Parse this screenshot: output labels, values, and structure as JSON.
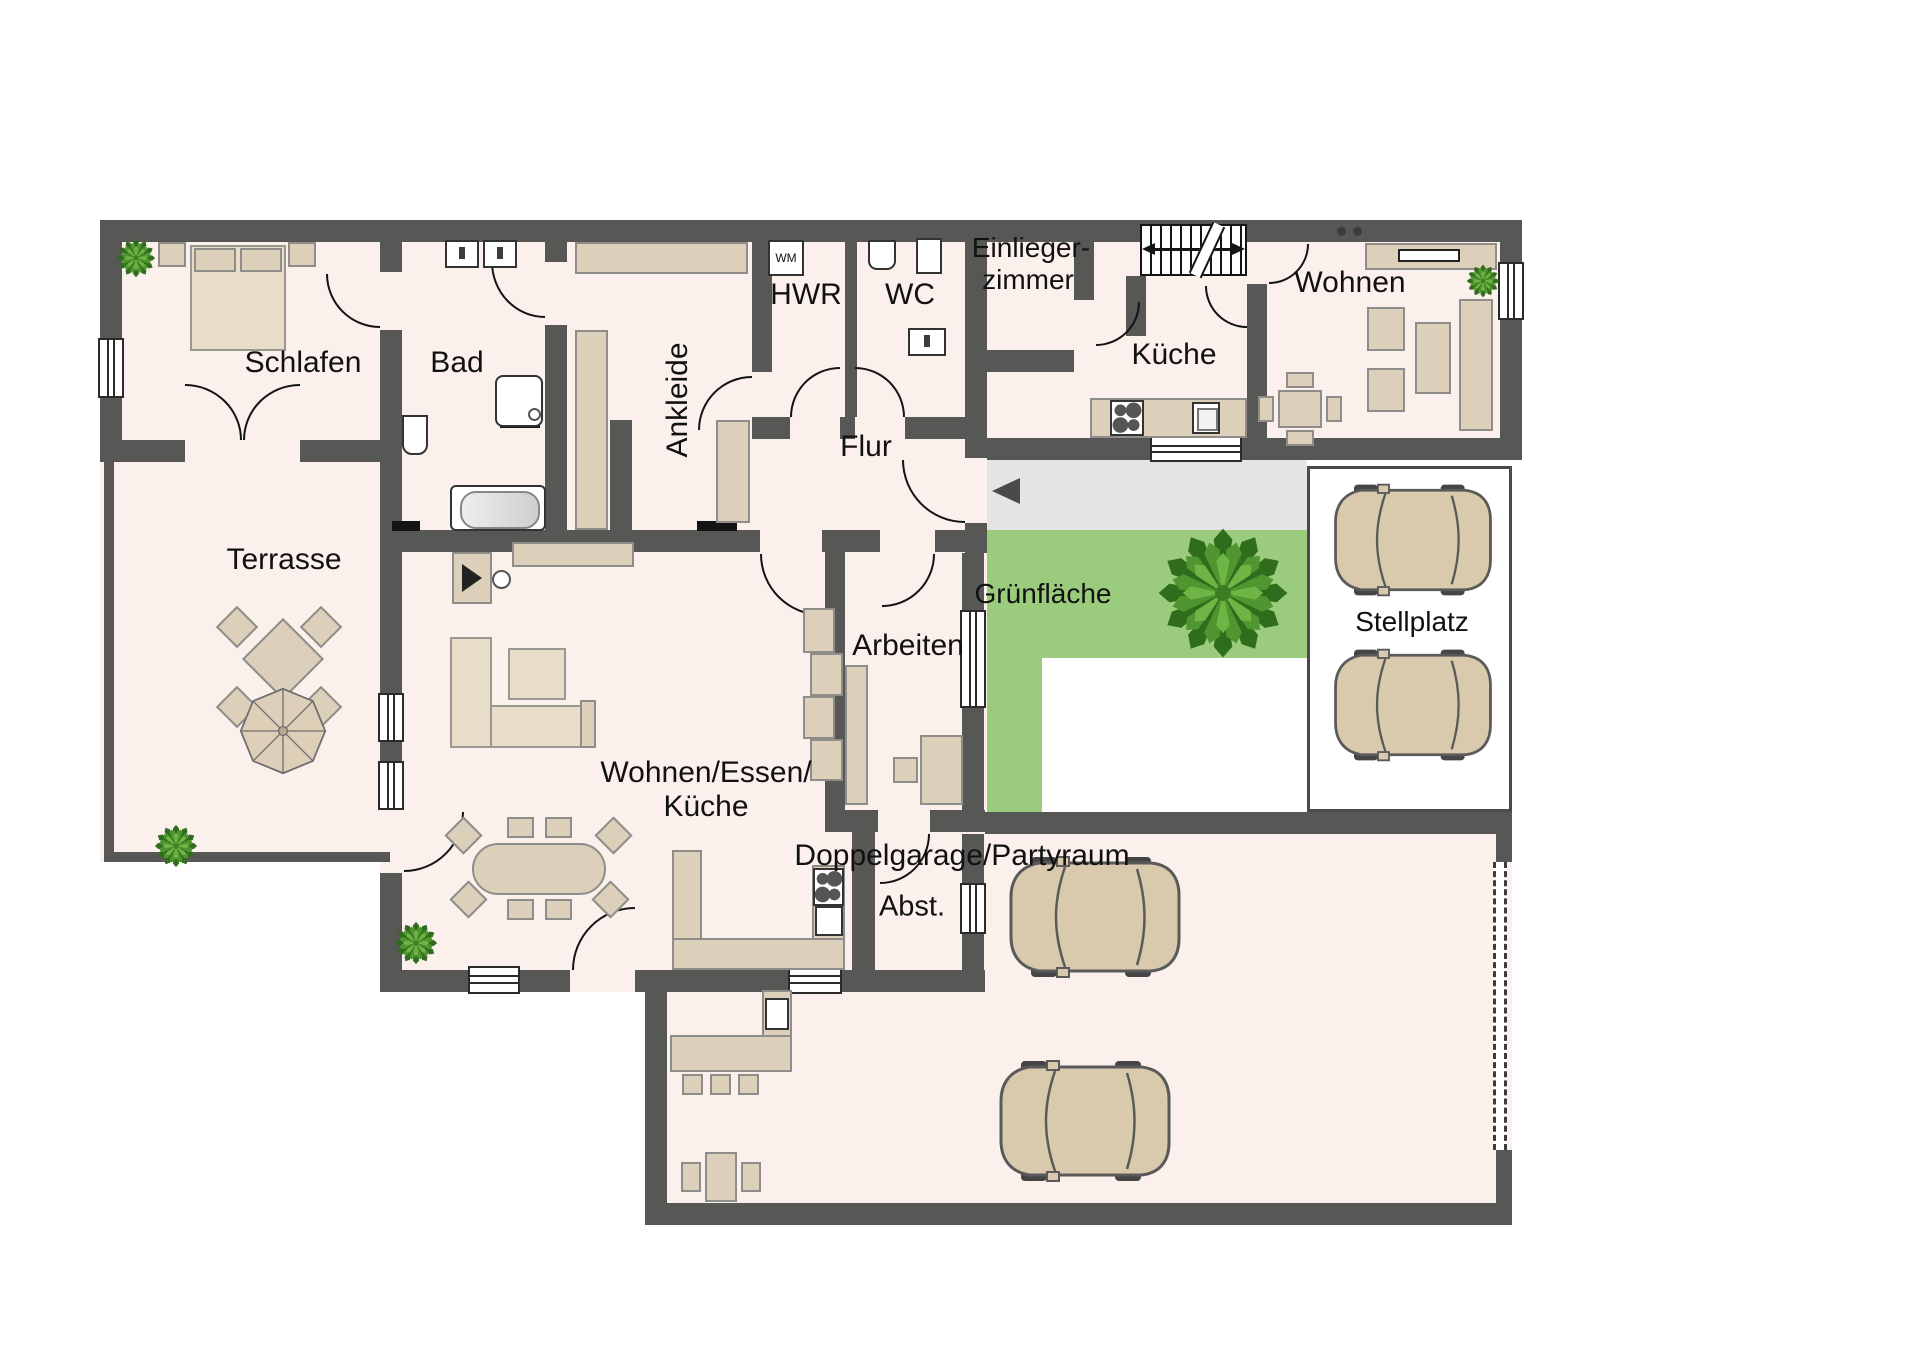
{
  "rooms": {
    "schlafen": {
      "label": "Schlafen"
    },
    "bad": {
      "label": "Bad"
    },
    "ankleide": {
      "label": "Ankleide"
    },
    "hwr": {
      "label": "HWR"
    },
    "wc": {
      "label": "WC"
    },
    "einliegerzimmer": {
      "label_line1": "Einlieger-",
      "label_line2": "zimmer"
    },
    "kueche_einlieger": {
      "label": "Küche"
    },
    "wohnen_einlieger": {
      "label": "Wohnen"
    },
    "flur": {
      "label": "Flur"
    },
    "terrasse": {
      "label": "Terrasse"
    },
    "arbeiten": {
      "label": "Arbeiten"
    },
    "wohnen_essen_kueche": {
      "label_line1": "Wohnen/Essen/",
      "label_line2": "Küche"
    },
    "abstellraum": {
      "label": "Abst."
    },
    "gruenflaeche": {
      "label": "Grünfläche"
    },
    "stellplatz": {
      "label": "Stellplatz"
    },
    "doppelgarage": {
      "label": "Doppelgarage/Partyraum"
    }
  },
  "appliances": {
    "washing_machine": "WM"
  },
  "colors": {
    "wall": "#575756",
    "floor": "#fbf0ec",
    "furniture": "#ddd0ba",
    "green": "#9bcb7d",
    "walkway": "#e4e4e4",
    "tree_dark": "#2f6d1d",
    "tree_mid": "#4f9630",
    "tree_light": "#6fb545",
    "car_body": "#d9c9ad"
  }
}
